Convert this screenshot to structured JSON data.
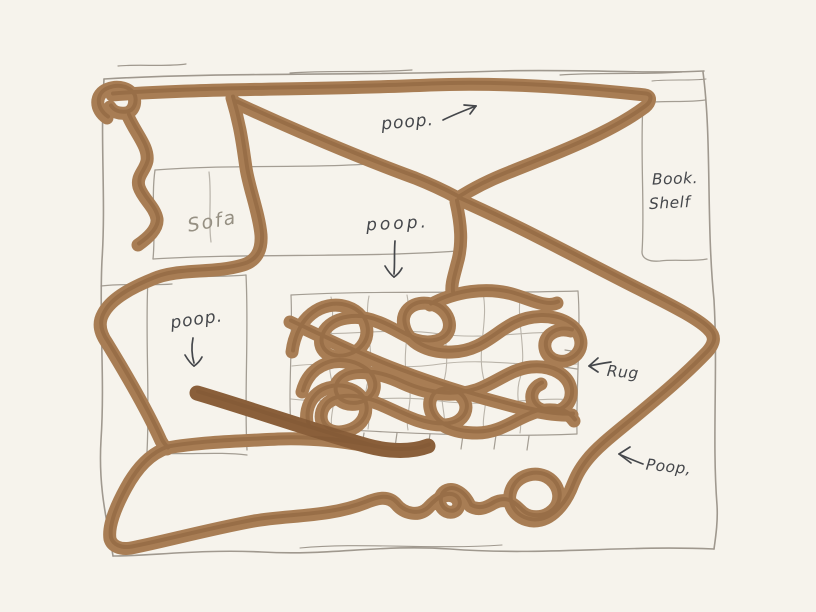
{
  "canvas": {
    "width": 816,
    "height": 612,
    "background": "#f6f3ec"
  },
  "colors": {
    "trail": "#a87d54",
    "trail_shade": "#7f5733",
    "trail_heavy": "#8a5f3a",
    "pencil": "#9b948a",
    "pencil_light": "#b0aa9f",
    "ink": "#45474b",
    "ink_faint": "#969083"
  },
  "labels": {
    "poop_top": "poop.",
    "poop_middle": "poop.",
    "poop_left": "poop.",
    "sofa": "Sofa",
    "bookshelf_line1": "Book.",
    "bookshelf_line2": "Shelf",
    "rug": "Rug",
    "poop_bottom": "Poop,"
  },
  "icons": {
    "arrow_top": "↗",
    "arrow_middle": "↓",
    "arrow_left_poop": "↓",
    "arrow_rug": "←",
    "arrow_bottom": "←"
  }
}
